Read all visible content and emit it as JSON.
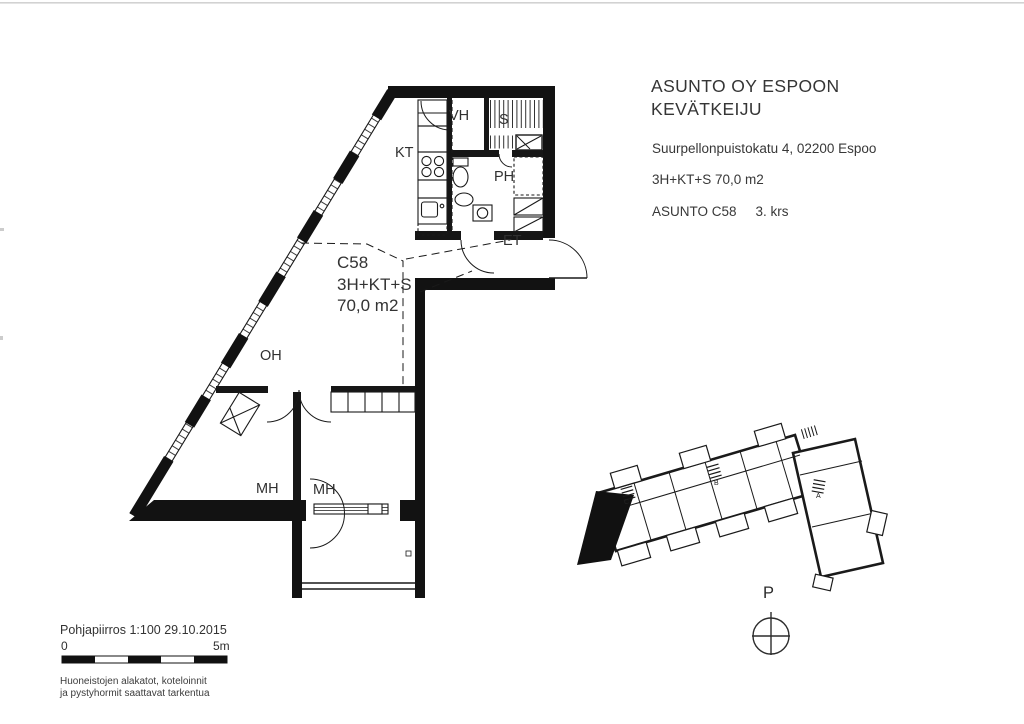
{
  "title_block": {
    "company_line1": "ASUNTO OY ESPOON",
    "company_line2": "KEVÄTKEIJU",
    "address": "Suurpellonpuistokatu 4, 02200 Espoo",
    "apartment_type": "3H+KT+S 70,0 m2",
    "unit": "ASUNTO C58",
    "floor": "3. krs"
  },
  "plan_label": {
    "unit": "C58",
    "type": "3H+KT+S",
    "area": "70,0 m2"
  },
  "room_labels": {
    "vh": "VH",
    "s": "S",
    "kt": "KT",
    "ph": "PH",
    "et": "ET",
    "oh": "OH",
    "mh_left": "MH",
    "mh_center": "MH"
  },
  "footer": {
    "drawing_title": "Pohjapiirros 1:100 29.10.2015",
    "scale_zero": "0",
    "scale_max": "5m",
    "note_line1": "Huoneistojen alakatot, koteloinnit",
    "note_line2": "ja pystyhormit saattavat tarkentua"
  },
  "compass": {
    "north_label": "P"
  },
  "site_plan": {
    "stair_c": "C",
    "stair_b": "B",
    "stair_a": "A"
  },
  "colors": {
    "paper": "#ffffff",
    "ink": "#2f2f2f",
    "wall": "#141414"
  }
}
